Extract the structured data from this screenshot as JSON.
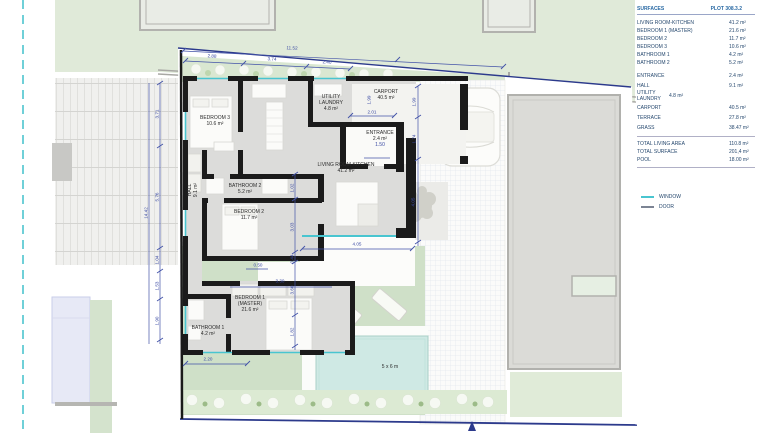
{
  "table": {
    "header": {
      "col1": "SURFACES",
      "col2": "PLOT 308.3.2"
    },
    "rows": [
      {
        "label": "LIVING ROOM-KITCHEN",
        "value": "41.2 m²"
      },
      {
        "label": "BEDROOM 1 (MASTER)",
        "value": "21.6 m²"
      },
      {
        "label": "BEDROOM 2",
        "value": "11.7 m²"
      },
      {
        "label": "BEDROOM 3",
        "value": "10.6 m²"
      },
      {
        "label": "BATHROOM 1",
        "value": "4.2 m²"
      },
      {
        "label": "BATHROOM 2",
        "value": "5.2 m²"
      },
      {
        "label": "ENTRANCE",
        "value": "2.4 m²"
      },
      {
        "label": "HALL",
        "value": "9.1 m²"
      },
      {
        "label": "UTILITY LAUNDRY",
        "value": "4.8 m²"
      },
      {
        "label": "CARPORT",
        "value": "40.5 m²"
      },
      {
        "label": "TERRACE",
        "value": "27.8 m²"
      },
      {
        "label": "GRASS",
        "value": "38.47 m²"
      }
    ],
    "totals": [
      {
        "label": "TOTAL LIVING AREA",
        "value": "110.8 m²"
      },
      {
        "label": "TOTAL SURFACE",
        "value": "201,4 m²"
      },
      {
        "label": "POOL",
        "value": "18.00 m²"
      }
    ]
  },
  "legend": {
    "window": "WINDOW",
    "door": "DOOR"
  },
  "plan": {
    "rooms": {
      "bedroom3": {
        "name": "BEDROOM 3",
        "area": "10.6 m²"
      },
      "utility": {
        "name1": "UTILITY",
        "name2": "LAUNDRY",
        "area": "4.8 m²"
      },
      "carport": {
        "name": "CARPORT",
        "area": "40.5 m²"
      },
      "entrance": {
        "name": "ENTRANCE",
        "area": "2.4 m²",
        "door_width": "1.50"
      },
      "living": {
        "name": "LIVING ROOM-KITCHEN",
        "area": "41.2 m²"
      },
      "hall": {
        "name": "HALL",
        "area": "9.1 m²"
      },
      "bathroom2": {
        "name": "BATHROOM 2",
        "area": "5.2 m²"
      },
      "bedroom2": {
        "name": "BEDROOM 2",
        "area": "11.7 m²"
      },
      "bedroom1": {
        "name": "BEDROOM 1",
        "name2": "(MASTER)",
        "area": "21.6 m²"
      },
      "bathroom1": {
        "name": "BATHROOM 1",
        "area": "4.2 m²"
      },
      "pool": {
        "label": "5 x 6 m"
      }
    },
    "dimensions": [
      "11.52",
      "2.88",
      "3.74",
      "2.40",
      "14.42",
      "3.71",
      "5.76",
      "1.04",
      "1.53",
      "1.90",
      "1.99",
      "2.01",
      "1.99",
      "1.74",
      "4.05",
      "1.02",
      "3.03",
      "0.44",
      "3.60",
      "1.82",
      "4.05",
      "0.50",
      "3.30",
      "2.20"
    ]
  },
  "colors": {
    "boundary": "#2c3a8c",
    "window": "#49c5d0",
    "door": "#7c8494",
    "wall": "#1b1b1b",
    "grass": "#cfe0c8",
    "pool": "#cfe9e4"
  }
}
